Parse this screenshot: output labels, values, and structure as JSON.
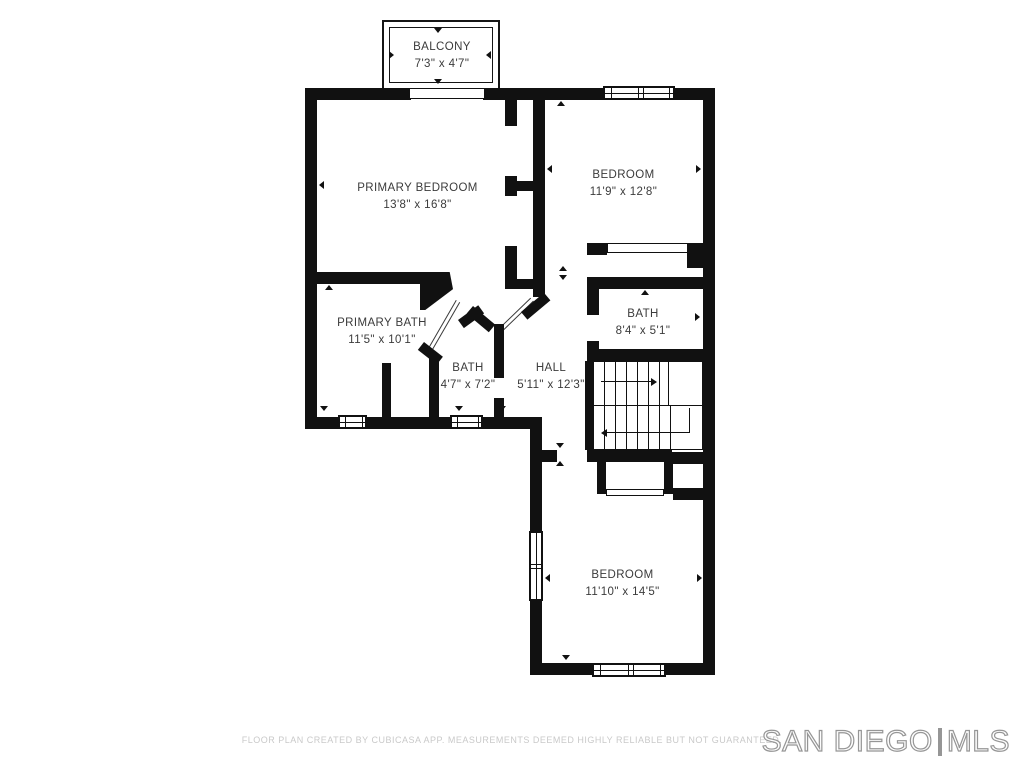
{
  "floor_plan": {
    "wall_color": "#111111",
    "label_color": "#3b3b3b",
    "rooms": [
      {
        "name": "BALCONY",
        "dims": "7'3\" x 4'7\""
      },
      {
        "name": "PRIMARY BEDROOM",
        "dims": "13'8\" x 16'8\""
      },
      {
        "name": "BEDROOM",
        "dims": "11'9\" x 12'8\""
      },
      {
        "name": "PRIMARY BATH",
        "dims": "11'5\" x 10'1\""
      },
      {
        "name": "BATH",
        "dims": "4'7\" x 7'2\""
      },
      {
        "name": "HALL",
        "dims": "5'11\" x 12'3\""
      },
      {
        "name": "BATH",
        "dims": "8'4\" x 5'1\""
      },
      {
        "name": "BEDROOM",
        "dims": "11'10\" x 14'5\""
      }
    ]
  },
  "footer": {
    "disclaimer": "FLOOR PLAN CREATED BY CUBICASA APP. MEASUREMENTS DEEMED HIGHLY RELIABLE BUT NOT GUARANTEED.",
    "color": "#c9c9c9"
  },
  "branding": {
    "left": "SAN DIEGO",
    "separator": "|",
    "right": "MLS",
    "color": "#969696"
  }
}
